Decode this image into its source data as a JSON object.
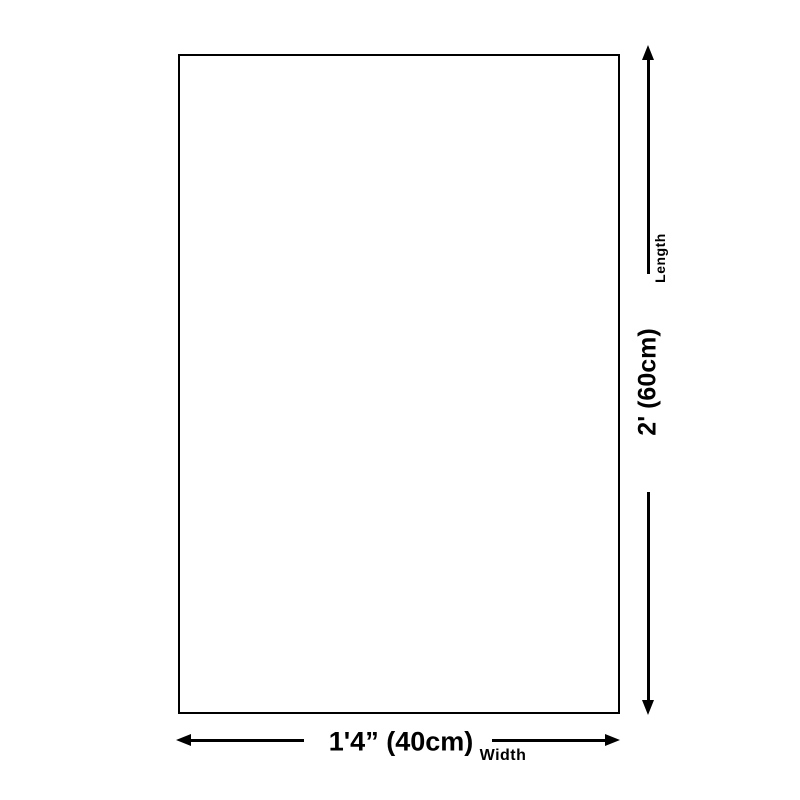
{
  "diagram": {
    "type": "product-dimension-diagram",
    "dimensions": {
      "length": {
        "value": "2' (60cm)",
        "label": "Length",
        "orientation": "vertical"
      },
      "width": {
        "value": "1'4” (40cm)",
        "label": "Width",
        "orientation": "horizontal"
      }
    }
  },
  "colors": {
    "line": "#000000",
    "text": "#000000",
    "background": "#ffffff"
  }
}
